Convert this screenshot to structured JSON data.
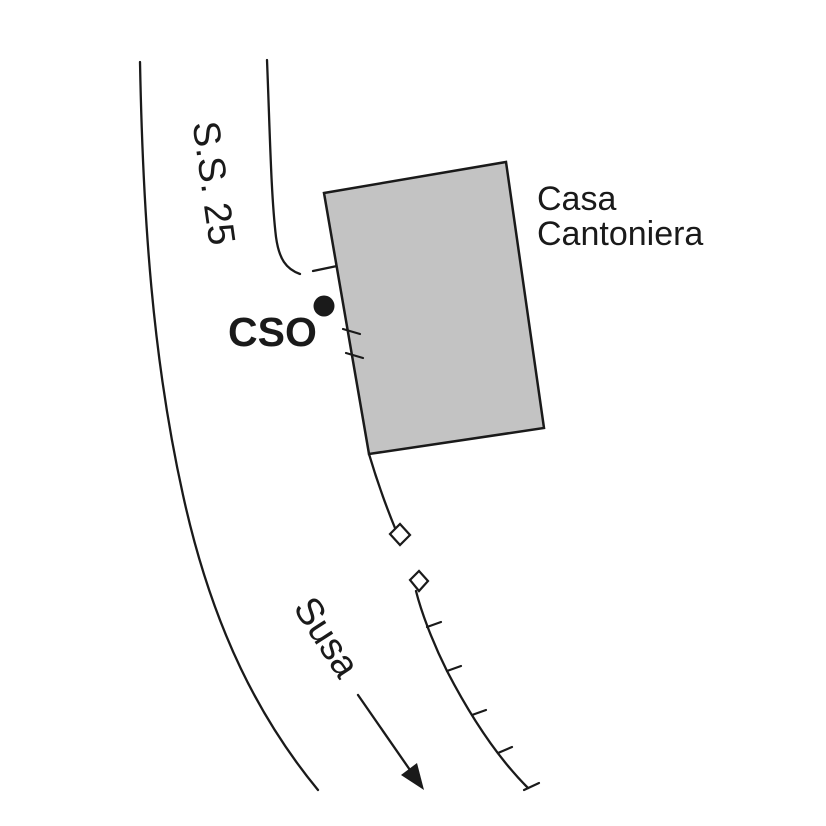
{
  "map": {
    "road_label": "S.S. 25",
    "station_label": "CSO",
    "building_label": {
      "line1": "Casa",
      "line2": "Cantoniera"
    },
    "direction_label": "Susa",
    "symbols": {
      "station_marker": "filled-circle",
      "direction_arrow": "arrow-down-right",
      "road_edges": "curved-double-line",
      "embankment_ticks": "hachure-marks",
      "path_squares": "small-open-squares"
    }
  },
  "colors": {
    "background": "#ffffff",
    "line_color": "#1a1a1a",
    "text_color": "#1a1a1a",
    "building_fill": "#c3c3c3",
    "building_stroke": "#1a1a1a"
  }
}
